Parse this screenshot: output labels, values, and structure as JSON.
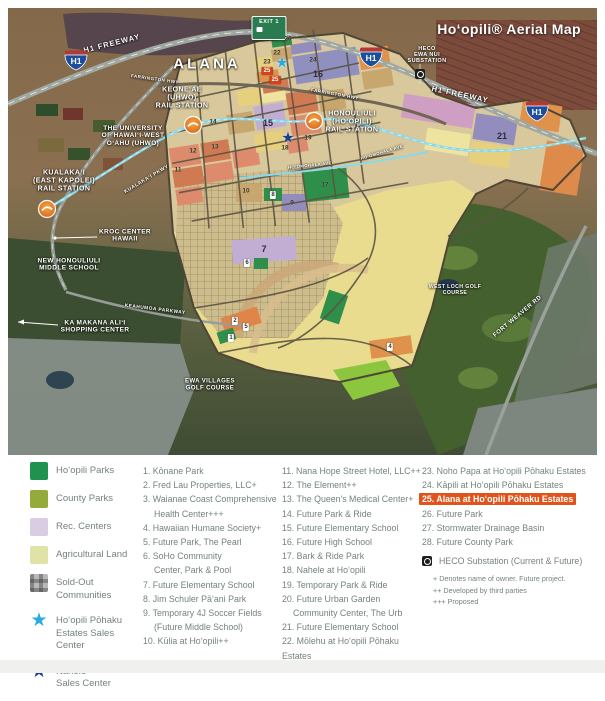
{
  "map": {
    "title": "Hoʻopili® Aerial Map",
    "labels": [
      {
        "id": "h1-freeway-west",
        "lines": [
          "H1 FREEWAY"
        ],
        "x": 104,
        "y": 36,
        "rot": -14,
        "size": 7.5,
        "ls": 1
      },
      {
        "id": "alana",
        "lines": [
          "ALANA"
        ],
        "x": 199,
        "y": 57,
        "rot": 0,
        "size": 15,
        "ls": 3
      },
      {
        "id": "farrington-hwy-west",
        "lines": [
          "FARRINGTON HWY"
        ],
        "x": 147,
        "y": 71,
        "rot": 8,
        "size": 4.5,
        "ls": 0.5
      },
      {
        "id": "keoneae-rail-station",
        "lines": [
          "KEONEʻAE",
          "(UHWO)",
          "RAIL STATION"
        ],
        "x": 174,
        "y": 90,
        "rot": 0,
        "size": 7
      },
      {
        "id": "uhwo",
        "lines": [
          "THE UNIVERSITY",
          "OF HAWAIʻI-WEST",
          "OʻAHU (UHWO)"
        ],
        "x": 125,
        "y": 128,
        "rot": 0,
        "size": 6.5
      },
      {
        "id": "heco-ewa-nui-substation",
        "lines": [
          "HECO",
          "EWA NUI",
          "SUBSTATION"
        ],
        "x": 419,
        "y": 47,
        "rot": 0,
        "size": 5.5
      },
      {
        "id": "h1-freeway-east",
        "lines": [
          "H1 FREEWAY"
        ],
        "x": 452,
        "y": 87,
        "rot": 12,
        "size": 7.5,
        "ls": 1
      },
      {
        "id": "farrington-hwy-east",
        "lines": [
          "FARRINGTON HWY"
        ],
        "x": 327,
        "y": 86,
        "rot": 10,
        "size": 4.5,
        "ls": 0.5
      },
      {
        "id": "honouliuli-rail-station",
        "lines": [
          "HONOULIULI",
          "(HOʻOPILI)",
          "RAIL STATION"
        ],
        "x": 344,
        "y": 114,
        "rot": 0,
        "size": 7
      },
      {
        "id": "kualakai-pkwy",
        "lines": [
          "KUALAKAʻI PKWY"
        ],
        "x": 139,
        "y": 172,
        "rot": -31,
        "size": 5,
        "ls": 0.5
      },
      {
        "id": "kualakai-rail-station",
        "lines": [
          "KUALAKAʻI",
          "(EAST KAPOLEI)",
          "RAIL STATION"
        ],
        "x": 56,
        "y": 173,
        "rot": 0,
        "size": 7
      },
      {
        "id": "kroc-center",
        "lines": [
          "KROC CENTER",
          "HAWAII"
        ],
        "x": 117,
        "y": 228,
        "rot": 0,
        "size": 6.5
      },
      {
        "id": "new-honouliuli-middle-school",
        "lines": [
          "NEW HONOULIULI",
          "MIDDLE SCHOOL"
        ],
        "x": 61,
        "y": 257,
        "rot": 0,
        "size": 6.5
      },
      {
        "id": "keahumoa-parkway",
        "lines": [
          "KEAHUMOA PARKWAY"
        ],
        "x": 147,
        "y": 302,
        "rot": 7,
        "size": 4.8,
        "ls": 0.5
      },
      {
        "id": "ka-makana-alii",
        "lines": [
          "KA MAKANA ALIʻI",
          "SHOPPING CENTER"
        ],
        "x": 87,
        "y": 319,
        "rot": 0,
        "size": 6.5
      },
      {
        "id": "west-loch-golf",
        "lines": [
          "WEST LOCH GOLF",
          "COURSE"
        ],
        "x": 447,
        "y": 283,
        "rot": 0,
        "size": 5.2
      },
      {
        "id": "fort-weaver-rd",
        "lines": [
          "FORT WEAVER RD"
        ],
        "x": 510,
        "y": 309,
        "rot": -40,
        "size": 6,
        "ls": 0.5
      },
      {
        "id": "ewa-villages-golf",
        "lines": [
          "EWA VILLAGES",
          "GOLF COURSE"
        ],
        "x": 202,
        "y": 377,
        "rot": 0,
        "size": 6
      },
      {
        "id": "hoomohala-ave-1",
        "lines": [
          "HOʻOMOHALA AVE"
        ],
        "x": 302,
        "y": 158,
        "rot": -6,
        "size": 4.2
      },
      {
        "id": "hoomohala-ave-2",
        "lines": [
          "HOʻOMOHALA AVE"
        ],
        "x": 374,
        "y": 145,
        "rot": -17,
        "size": 4.2
      }
    ],
    "markers": [
      {
        "n": "26",
        "x": 280,
        "y": 31,
        "kind": "num"
      },
      {
        "n": "22",
        "x": 269,
        "y": 45,
        "kind": "num"
      },
      {
        "n": "23",
        "x": 259,
        "y": 54,
        "kind": "num"
      },
      {
        "n": "24",
        "x": 305,
        "y": 52,
        "kind": "num"
      },
      {
        "n": "16",
        "x": 310,
        "y": 66,
        "kind": "numBig"
      },
      {
        "n": "25",
        "x": 259,
        "y": 63,
        "kind": "red"
      },
      {
        "n": "25",
        "x": 267,
        "y": 72,
        "kind": "red"
      },
      {
        "n": "21",
        "x": 494,
        "y": 128,
        "kind": "numBig"
      },
      {
        "n": "14",
        "x": 205,
        "y": 114,
        "kind": "num"
      },
      {
        "n": "15",
        "x": 260,
        "y": 115,
        "kind": "numBig"
      },
      {
        "n": "19",
        "x": 300,
        "y": 130,
        "kind": "num"
      },
      {
        "n": "18",
        "x": 277,
        "y": 140,
        "kind": "num"
      },
      {
        "n": "13",
        "x": 207,
        "y": 139,
        "kind": "num"
      },
      {
        "n": "12",
        "x": 185,
        "y": 143,
        "kind": "num"
      },
      {
        "n": "11",
        "x": 170,
        "y": 162,
        "kind": "num"
      },
      {
        "n": "10",
        "x": 238,
        "y": 183,
        "kind": "num"
      },
      {
        "n": "8",
        "x": 265,
        "y": 187,
        "kind": "box"
      },
      {
        "n": "9",
        "x": 284,
        "y": 195,
        "kind": "num"
      },
      {
        "n": "17",
        "x": 317,
        "y": 177,
        "kind": "num"
      },
      {
        "n": "7",
        "x": 256,
        "y": 241,
        "kind": "numBig"
      },
      {
        "n": "6",
        "x": 239,
        "y": 255,
        "kind": "box"
      },
      {
        "n": "2",
        "x": 227,
        "y": 313,
        "kind": "box"
      },
      {
        "n": "5",
        "x": 238,
        "y": 319,
        "kind": "box"
      },
      {
        "n": "1",
        "x": 223,
        "y": 330,
        "kind": "box"
      },
      {
        "n": "4",
        "x": 382,
        "y": 339,
        "kind": "box"
      }
    ],
    "icons": [
      {
        "type": "exit-sign",
        "x": 261,
        "y": 20,
        "text": "EXIT 1"
      },
      {
        "type": "h1-shield",
        "x": 68,
        "y": 52,
        "text": "H1"
      },
      {
        "type": "h1-shield",
        "x": 363,
        "y": 49,
        "text": "H1"
      },
      {
        "type": "h1-shield",
        "x": 529,
        "y": 103,
        "text": "H1"
      },
      {
        "type": "station",
        "x": 185,
        "y": 117
      },
      {
        "type": "station",
        "x": 306,
        "y": 113
      },
      {
        "type": "station",
        "x": 39,
        "y": 201
      },
      {
        "type": "star",
        "x": 274,
        "y": 55,
        "color": "#29abe2"
      },
      {
        "type": "star",
        "x": 280,
        "y": 130,
        "color": "#1d3d8f"
      },
      {
        "type": "heco-square",
        "x": 412,
        "y": 66
      }
    ]
  },
  "legend": {
    "swatches": [
      {
        "kind": "fill",
        "color": "#219150",
        "lines": [
          "Hoʻopili Parks"
        ]
      },
      {
        "kind": "fill",
        "color": "#94ab3b",
        "lines": [
          "County Parks"
        ]
      },
      {
        "kind": "fill",
        "color": "#d9cce3",
        "lines": [
          "Rec. Centers"
        ]
      },
      {
        "kind": "fill",
        "color": "#dfe3a6",
        "lines": [
          "Agricultural Land"
        ]
      },
      {
        "kind": "plaid",
        "color": "#b9b9b9",
        "lines": [
          "Sold-Out",
          "Communities"
        ]
      },
      {
        "kind": "star",
        "color": "#29abe2",
        "lines": [
          "Hoʻopili Pōhaku",
          "Estates Sales",
          "Center"
        ]
      },
      {
        "kind": "star",
        "color": "#1d3d8f",
        "lines": [
          "Nahele",
          "Sales Center"
        ]
      }
    ],
    "col1": [
      {
        "num": "1.",
        "lines": [
          "Kōnane Park"
        ]
      },
      {
        "num": "2.",
        "lines": [
          "Fred Lau Properties, LLC+"
        ]
      },
      {
        "num": "3.",
        "lines": [
          "Waianae Coast Comprehensive",
          "Health Center+++"
        ]
      },
      {
        "num": "4.",
        "lines": [
          "Hawaiian Humane Society+"
        ]
      },
      {
        "num": "5.",
        "lines": [
          "Future Park, The Pearl"
        ]
      },
      {
        "num": "6.",
        "lines": [
          "SoHo Community",
          "Center, Park & Pool"
        ]
      },
      {
        "num": "7.",
        "lines": [
          "Future Elementary School"
        ]
      },
      {
        "num": "8.",
        "lines": [
          "Jim Schuler Pāʻani Park"
        ]
      },
      {
        "num": "9.",
        "lines": [
          "Temporary 4J Soccer Fields",
          "(Future Middle School)"
        ]
      },
      {
        "num": "10.",
        "lines": [
          "Kūlia at Hoʻopili++"
        ]
      }
    ],
    "col2": [
      {
        "num": "11.",
        "lines": [
          "Nana Hope Street Hotel, LLC++"
        ]
      },
      {
        "num": "12.",
        "lines": [
          "The Element++"
        ]
      },
      {
        "num": "13.",
        "lines": [
          "The Queen's Medical Center+"
        ]
      },
      {
        "num": "14.",
        "lines": [
          "Future Park & Ride"
        ]
      },
      {
        "num": "15.",
        "lines": [
          "Future Elementary School"
        ]
      },
      {
        "num": "16.",
        "lines": [
          "Future High School"
        ]
      },
      {
        "num": "17.",
        "lines": [
          "Bark & Ride Park"
        ]
      },
      {
        "num": "18.",
        "lines": [
          "Nahele at Hoʻopili"
        ]
      },
      {
        "num": "19.",
        "lines": [
          "Temporary Park & Ride"
        ]
      },
      {
        "num": "20.",
        "lines": [
          "Future Urban Garden",
          "Community Center, The Urb"
        ]
      },
      {
        "num": "21.",
        "lines": [
          "Future Elementary School"
        ]
      },
      {
        "num": "22.",
        "lines": [
          "Mōlehu at Hoʻopili Pōhaku Estates"
        ]
      }
    ],
    "col3": [
      {
        "num": "23.",
        "lines": [
          "Noho Papa at Hoʻopili Pōhaku Estates"
        ]
      },
      {
        "num": "24.",
        "lines": [
          "Kāpili at Hoʻopili Pōhaku Estates"
        ]
      },
      {
        "num": "25.",
        "lines": [
          "Alana at Hoʻopili Pōhaku Estates"
        ],
        "highlight": true
      },
      {
        "num": "26.",
        "lines": [
          "Future Park"
        ]
      },
      {
        "num": "27.",
        "lines": [
          "Stormwater Drainage Basin"
        ]
      },
      {
        "num": "28.",
        "lines": [
          "Future County Park"
        ]
      }
    ],
    "heco": "HECO Substation (Current & Future)",
    "footnotes": [
      "+ Denotes name of owner. Future project.",
      "++ Developed by third parties",
      "+++ Proposed"
    ],
    "highlight_color": "#e0541c"
  }
}
